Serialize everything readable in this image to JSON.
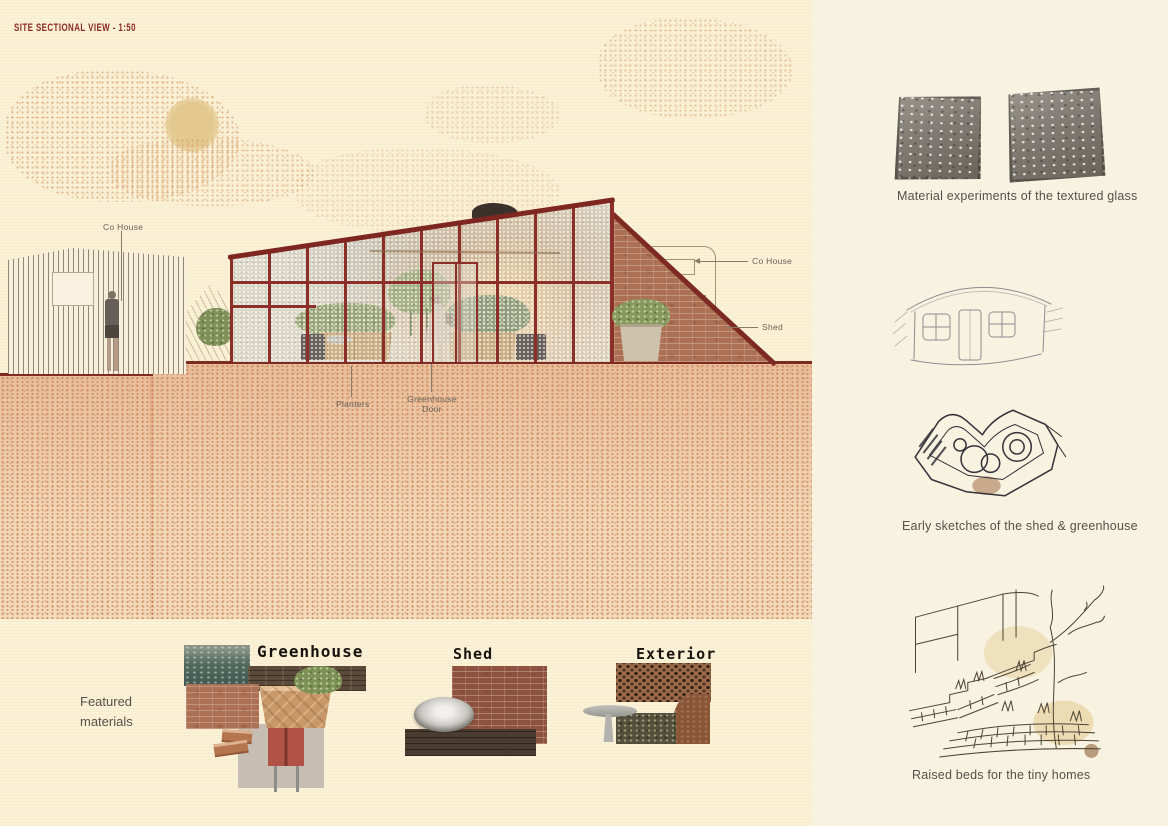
{
  "title": "SITE SECTIONAL VIEW - 1:50",
  "colors": {
    "paper": "#faf1d6",
    "frame_red": "#8c2f28",
    "ground_line_red": "#7c2a22",
    "ground_stipple": "#cf9469",
    "ink": "#56504a",
    "label_brown": "#6b6257"
  },
  "drawing": {
    "labels": {
      "co_house_left": "Co House",
      "planters": "Planters",
      "greenhouse_door": "Greenhouse Door",
      "co_house_right": "Co House",
      "shed": "Shed"
    }
  },
  "right_column": {
    "captions": {
      "glass": "Material experiments of the textured glass",
      "sketches": "Early sketches of the shed & greenhouse",
      "raised_beds": "Raised beds for the tiny homes"
    }
  },
  "materials": {
    "intro_line1": "Featured",
    "intro_line2": "materials",
    "sections": [
      {
        "label": "Greenhouse"
      },
      {
        "label": "Shed"
      },
      {
        "label": "Exterior"
      }
    ]
  }
}
